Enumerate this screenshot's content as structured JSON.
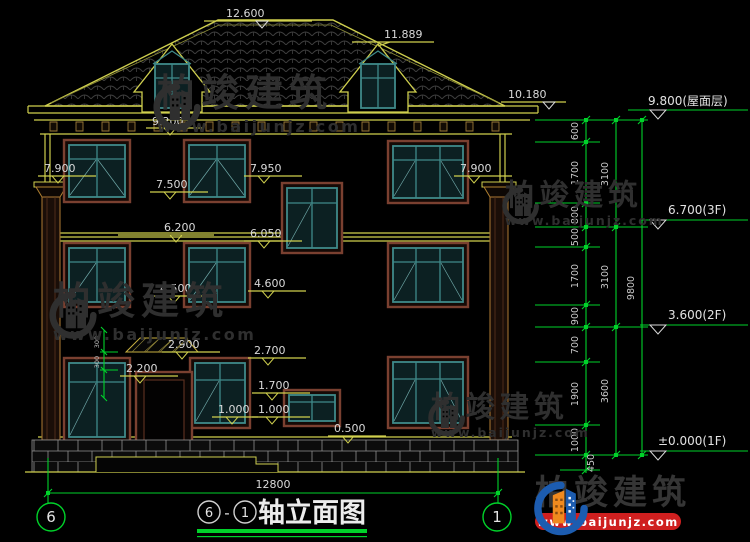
{
  "title": {
    "bubble_left": "6",
    "separator": "-",
    "bubble_right": "1",
    "text": "轴立面图"
  },
  "axes": {
    "left": "6",
    "right": "1"
  },
  "brand": {
    "name": "柏竣建筑",
    "url": "www.baijunjz.com"
  },
  "dims": {
    "marks": [
      "12.600",
      "11.889",
      "10.180",
      "9.200",
      "7.900",
      "7.950",
      "7.500",
      "7.900",
      "6.200",
      "6.050",
      "4.500",
      "4.600",
      "2.900",
      "2.700",
      "2.200",
      "1.700",
      "1.000",
      "1.000",
      "0.500"
    ],
    "levels": [
      "9.800(屋面层)",
      "6.700(3F)",
      "3.600(2F)",
      "±0.000(1F)"
    ],
    "right_chain_small": [
      "600",
      "1700",
      "800",
      "500",
      "1700",
      "900",
      "700",
      "1900",
      "1000",
      "450"
    ],
    "right_chain_mid": [
      "3100",
      "3100",
      "3600"
    ],
    "right_chain_total": "9800",
    "bottom_total": "12800",
    "canopy_small": [
      "300",
      "300"
    ]
  }
}
